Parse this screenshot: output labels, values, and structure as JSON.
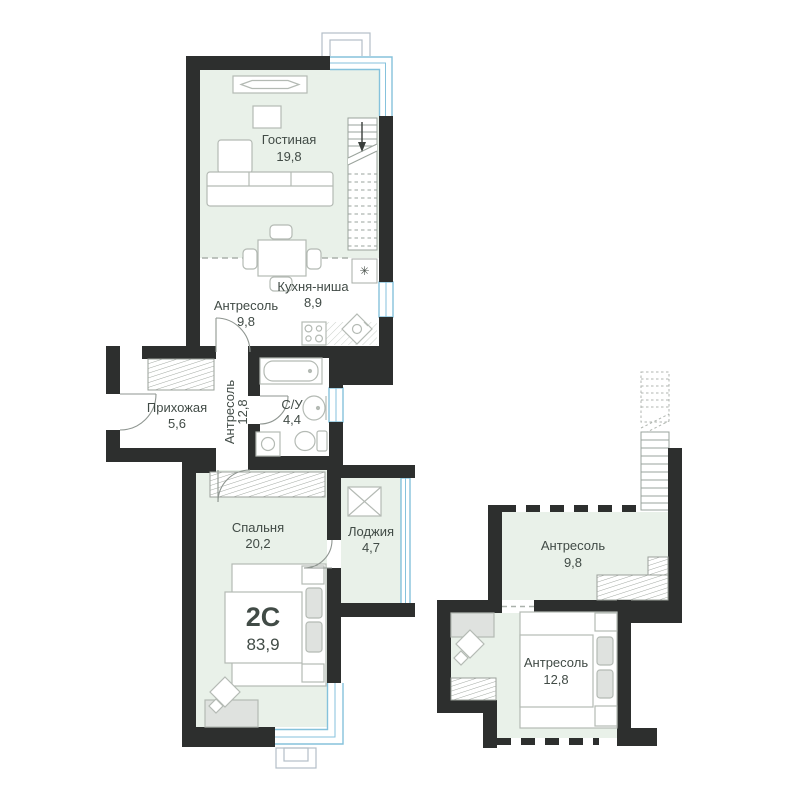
{
  "plan": {
    "badge": {
      "type": "2С",
      "area": "83,9"
    },
    "vent_symbol": "✳",
    "rooms": {
      "living": {
        "name": "Гостиная",
        "area": "19,8"
      },
      "kitchen": {
        "name": "Кухня-ниша",
        "area": "8,9"
      },
      "mezz1": {
        "name": "Антресоль",
        "area": "9,8"
      },
      "mezz2": {
        "name": "Антресоль",
        "area": "12,8"
      },
      "hall": {
        "name": "Прихожая",
        "area": "5,6"
      },
      "bath": {
        "name": "С/У",
        "area": "4,4"
      },
      "bedroom": {
        "name": "Спальня",
        "area": "20,2"
      },
      "loggia": {
        "name": "Лоджия",
        "area": "4,7"
      }
    },
    "mezzanine_level": {
      "mezz1": {
        "name": "Антресоль",
        "area": "9,8"
      },
      "mezz2": {
        "name": "Антресоль",
        "area": "12,8"
      }
    }
  },
  "colors": {
    "wall": "#2d2f2e",
    "room_fill": "#e9f1e9",
    "glazing": "#85c2dc",
    "text": "#414b46"
  }
}
